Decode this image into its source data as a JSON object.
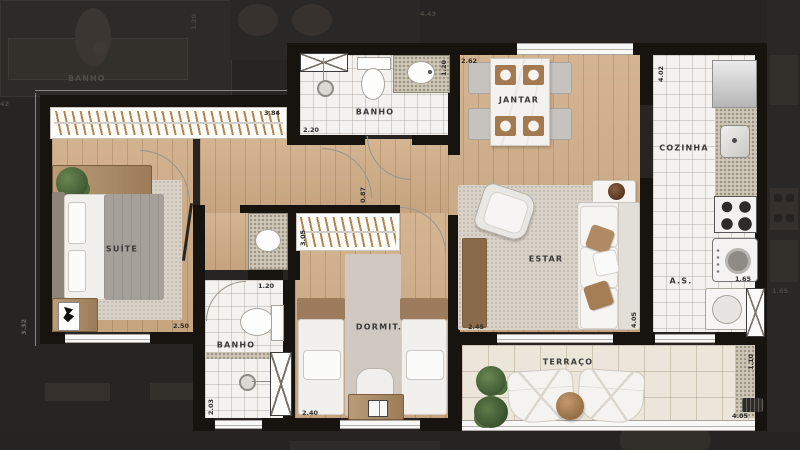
{
  "plan": {
    "rooms": {
      "suite": "SUÍTE",
      "banho1": "BANHO",
      "banho2": "BANHO",
      "jantar": "JANTAR",
      "cozinha": "COZINHA",
      "estar": "ESTAR",
      "as": "A.S.",
      "dormit": "DORMIT.",
      "terraco": "TERRAÇO"
    },
    "dims": {
      "suite_closet": "3.84",
      "suite_width": "2.50",
      "suite_height": "3.32",
      "banho1_width": "2.20",
      "banho1_counter": "1.20",
      "jantar_width": "2.62",
      "cozinha_height": "4.02",
      "hall": "0.87",
      "dormit_closet": "3.05",
      "banho2_width": "1.20",
      "banho2_height": "2.03",
      "dormit_width": "2.40",
      "estar_width": "2.45",
      "estar_height": "4.05",
      "as_width": "1.65",
      "terraco_height": "1.10",
      "terraco_width": "4.05"
    }
  },
  "background": {
    "banho_label": "BANHO",
    "dim_left": "3.42",
    "dim_top_1": "1.20",
    "dim_top_2": "4.43",
    "dim_right": "1.65"
  },
  "colors": {
    "background": "#282421",
    "wall": "#17130f",
    "wood_floor": "#cfac85",
    "tile_floor": "#f4f2ef",
    "terrace_tile": "#ebe5da",
    "rug": "#d8d2c8",
    "accent_pillow": "#b08a63",
    "plant": "#4a6639"
  }
}
